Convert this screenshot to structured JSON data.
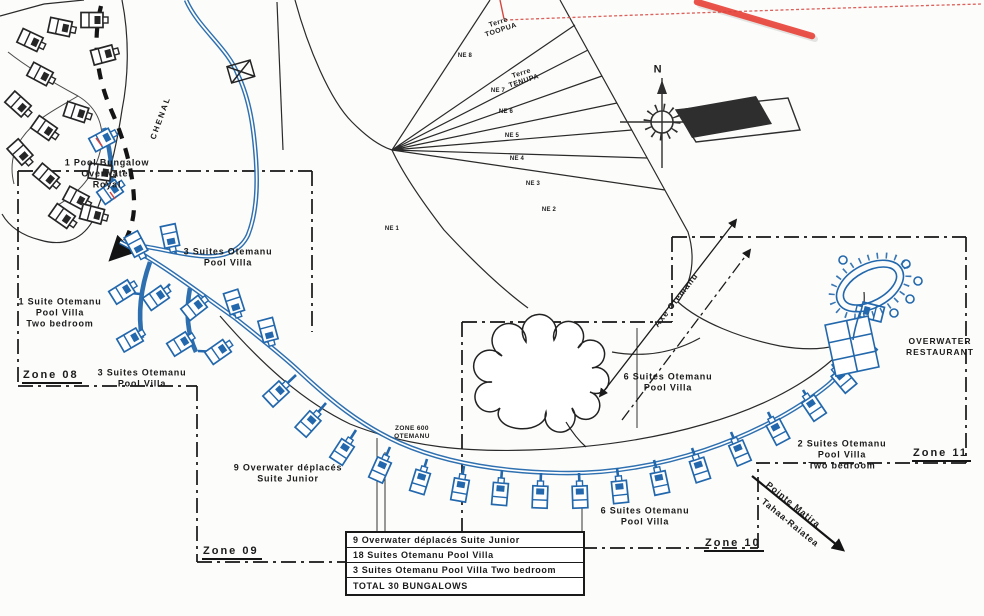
{
  "areas": {
    "pool_bungalow_overwater_royal": [
      "1 Pool Bungalow",
      "Overwater",
      "Royal"
    ],
    "suites3_north": [
      "3 Suites Otemanu",
      "Pool Villa"
    ],
    "suite1_two_bedroom": [
      "1 Suite Otemanu",
      "Pool Villa",
      "Two bedroom"
    ],
    "suites3_south": [
      "3 Suites Otemanu",
      "Pool Villa"
    ],
    "overwater_deplaces": [
      "9 Overwater déplacés",
      "Suite Junior"
    ],
    "suites6_north": [
      "6 Suites Otemanu",
      "Pool Villa"
    ],
    "suites6_south": [
      "6 Suites Otemanu",
      "Pool Villa"
    ],
    "suites2_two_bedroom": [
      "2 Suites Otemanu",
      "Pool Villa",
      "Two bedroom"
    ],
    "overwater_restaurant": [
      "OVERWATER",
      "RESTAURANT"
    ],
    "zone600": [
      "ZONE 600",
      "OTEMANU"
    ]
  },
  "zones": {
    "zone08": "Zone 08",
    "zone09": "Zone 09",
    "zone10": "Zone 10",
    "zone11": "Zone 11"
  },
  "legend": {
    "rows": [
      "9 Overwater déplacés Suite Junior",
      "18 Suites Otemanu Pool Villa",
      "3 Suites Otemanu Pool Villa Two bedroom"
    ],
    "total": "TOTAL 30 BUNGALOWS"
  },
  "terres": {
    "toopua": [
      "Terre",
      "TOOPUA"
    ],
    "tenupa": [
      "Terre",
      "TENUPA"
    ]
  },
  "parcels": [
    "NE 8",
    "NE 7",
    "NE 6",
    "NE 5",
    "NE 4",
    "NE 3",
    "NE 2",
    "NE 1"
  ],
  "compass": {
    "north": "N"
  },
  "annotations": {
    "axe_otemanu": "Axe Otemanu",
    "chenal": "CHENAL",
    "pointe": [
      "Pointe Matira",
      "Tahaa-Raiatea"
    ]
  },
  "colors": {
    "bungalow_blue": "#2368ac",
    "marker_red": "#e8443a",
    "ink": "#1b1b1b"
  }
}
